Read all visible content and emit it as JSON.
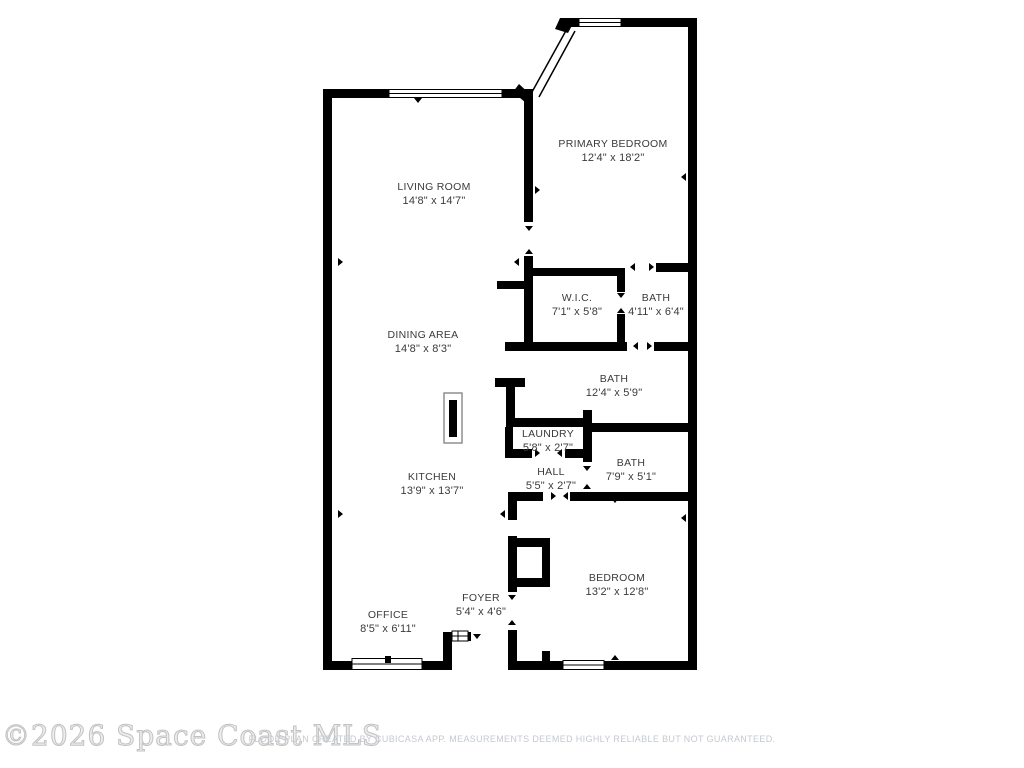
{
  "watermark": "©2026 Space Coast MLS",
  "disclaimer": "FLOOR PLAN CREATED BY CUBICASA APP. MEASUREMENTS DEEMED HIGHLY RELIABLE BUT NOT GUARANTEED.",
  "colors": {
    "background": "#ffffff",
    "wall": "#000000",
    "label_text": "#3b3b3b",
    "watermark_text": "#c2c2c2",
    "disclaimer_text": "#c4c9d0"
  },
  "rooms": [
    {
      "id": "primary-bedroom",
      "name": "PRIMARY BEDROOM",
      "dims": "12'4\" x 18'2\""
    },
    {
      "id": "living-room",
      "name": "LIVING ROOM",
      "dims": "14'8\" x 14'7\""
    },
    {
      "id": "wic",
      "name": "W.I.C.",
      "dims": "7'1\" x 5'8\""
    },
    {
      "id": "bath-upper",
      "name": "BATH",
      "dims": "4'11\" x 6'4\""
    },
    {
      "id": "dining-area",
      "name": "DINING AREA",
      "dims": "14'8\" x 8'3\""
    },
    {
      "id": "bath-middle",
      "name": "BATH",
      "dims": "12'4\" x 5'9\""
    },
    {
      "id": "laundry",
      "name": "LAUNDRY",
      "dims": "5'8\" x 2'7\""
    },
    {
      "id": "hall",
      "name": "HALL",
      "dims": "5'5\" x 2'7\""
    },
    {
      "id": "bath-lower",
      "name": "BATH",
      "dims": "7'9\" x 5'1\""
    },
    {
      "id": "kitchen",
      "name": "KITCHEN",
      "dims": "13'9\" x 13'7\""
    },
    {
      "id": "bedroom",
      "name": "BEDROOM",
      "dims": "13'2\" x 12'8\""
    },
    {
      "id": "foyer",
      "name": "FOYER",
      "dims": "5'4\" x 4'6\""
    },
    {
      "id": "office",
      "name": "OFFICE",
      "dims": "8'5\" x 6'11\""
    }
  ]
}
